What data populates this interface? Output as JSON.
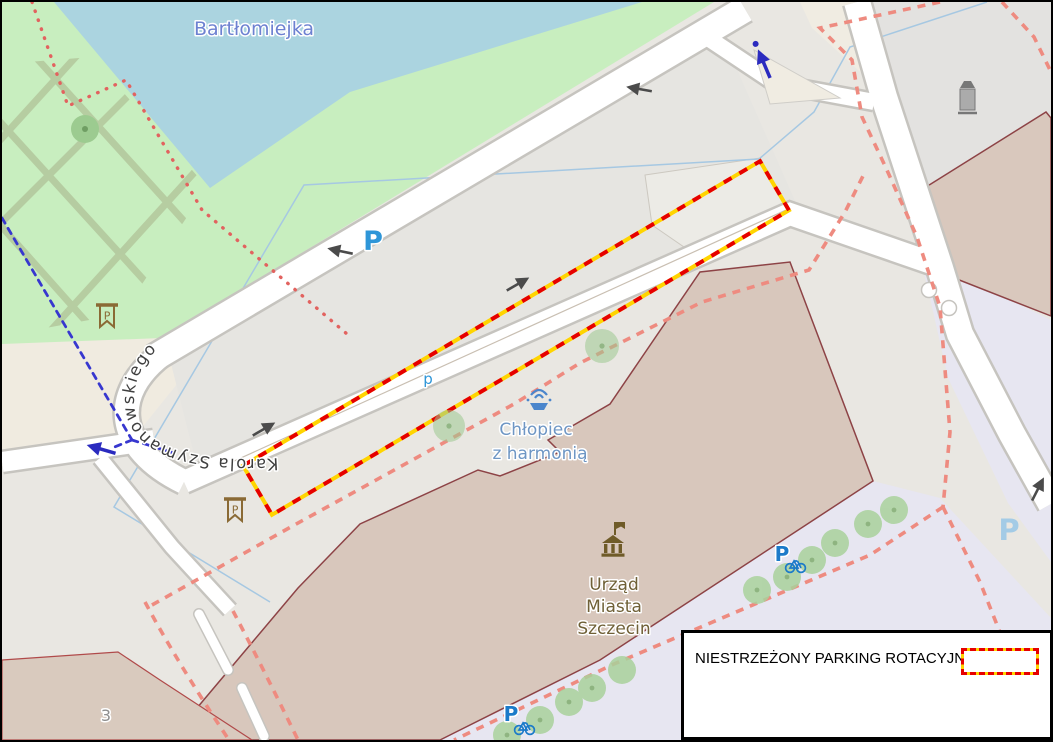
{
  "map": {
    "type": "openstreetmap-static-export",
    "labels": {
      "water_name": "Bartłomiejka",
      "street_name": "Karola Szymanowskiego",
      "fountain_line1": "Chłopiec",
      "fountain_line2": "z harmonią",
      "cityhall_line1": "Urząd",
      "cityhall_line2": "Miasta",
      "cityhall_line3": "Szczecin",
      "house_number": "3",
      "street_parking_p": "P",
      "street_parking_p_small": "p",
      "parking_area_p": "P",
      "bike_parking_p": "P",
      "banner_icon_letter": "P"
    },
    "icons": [
      "fountain-icon",
      "townhall-icon",
      "advertising-column-icon",
      "memorial-banner-icon",
      "bicycle-parking-icon",
      "one-way-arrow",
      "cycle-route-arrow",
      "crossing-node"
    ],
    "colors": {
      "water": "#abd4e0",
      "park": "#c8eebf",
      "park_path_hatch": "#b4c99e",
      "road_fill": "#ffffff",
      "road_casing": "#c6c4bf",
      "plaza": "#e9e7e2",
      "beige_area": "#f0ebe0",
      "lavender_area": "#e7e6f1",
      "building_fill": "#d9c8bd",
      "building_outline": "#8d4346",
      "boundary_pink_dash": "#ee8b80",
      "boundary_red_dots": "#e2625f",
      "cycle_route_blue": "#3737cf",
      "stream_blue": "#a6c8e2",
      "highlight_yellow": "#ffd400",
      "highlight_red": "#e60000",
      "parking_blue": "#2e96d8",
      "label_water": "#6d81d1",
      "label_fountain": "#6e96c4",
      "label_brown": "#6f6036"
    }
  },
  "legend": {
    "text": "NIESTRZEŻONY PARKING ROTACYJNY",
    "swatch": {
      "border_outer": "#ffd400",
      "border_dash": "#e60000",
      "fill": "#ffffff"
    }
  }
}
